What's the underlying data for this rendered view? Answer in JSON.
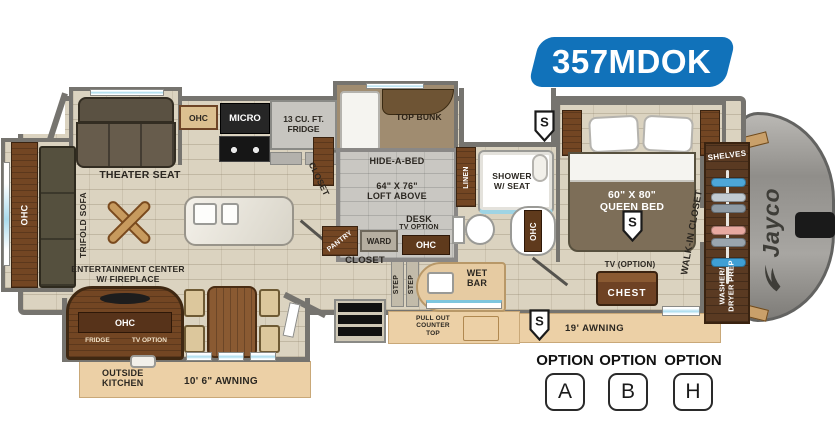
{
  "model_badge": {
    "text": "357MDOK",
    "bg": "#1172ba",
    "fg": "#ffffff"
  },
  "brand": {
    "logo": "Jayco"
  },
  "speaker_marker": {
    "letter": "S"
  },
  "options": {
    "items": [
      {
        "label": "OPTION",
        "letter": "A"
      },
      {
        "label": "OPTION",
        "letter": "B"
      },
      {
        "label": "OPTION",
        "letter": "H"
      }
    ]
  },
  "labels": {
    "theater_seat": "THEATER SEAT",
    "trifold_sofa": "TRIFOLD SOFA",
    "rear_ohc": "OHC",
    "kitchen_ohc": "OHC",
    "micro": "MICRO",
    "fridge_line1": "13 CU. FT.",
    "fridge_line2": "FRIDGE",
    "kitchen_closet": "CLOSET",
    "top_bunk": "TOP BUNK",
    "hide_a_bed": "HIDE-A-BED",
    "loft_line1": "64\" X 76\"",
    "loft_line2": "LOFT ABOVE",
    "desk": "DESK",
    "desk_tv": "TV OPTION",
    "pantry": "PANTRY",
    "ward": "WARD",
    "mid_ohc": "OHC",
    "mid_closet": "CLOSET",
    "step": "STEP",
    "wet": "WET",
    "bar": "BAR",
    "linen": "LINEN",
    "shower_line1": "SHOWER",
    "shower_line2": "W/ SEAT",
    "bath_ohc": "OHC",
    "queen_line1": "60\" X 80\"",
    "queen_line2": "QUEEN BED",
    "walk_in_closet": "WALK-IN CLOSET",
    "shelves": "SHELVES",
    "washer_line1": "WASHER/",
    "washer_line2": "DRYER PREP",
    "tv_option": "TV (OPTION)",
    "chest": "CHEST",
    "awning_19": "19' AWNING",
    "pull_out_line1": "PULL OUT",
    "pull_out_line2": "COUNTER",
    "pull_out_line3": "TOP",
    "entertainment_line1": "ENTERTAINMENT CENTER",
    "entertainment_line2": "W/ FIREPLACE",
    "ent_ohc": "OHC",
    "ent_fridge": "FRIDGE",
    "ent_tv": "TV OPTION",
    "outside_line1": "OUTSIDE",
    "outside_line2": "KITCHEN",
    "awning_10_6": "10' 6\" AWNING"
  }
}
